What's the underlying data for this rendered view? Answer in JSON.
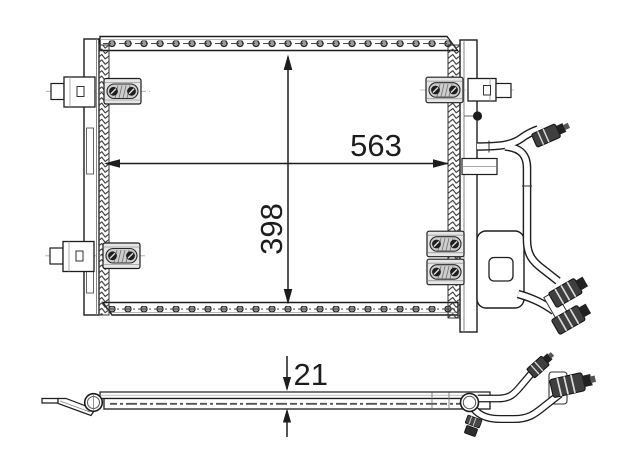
{
  "drawing": {
    "subject": "condenser-technical-drawing",
    "front_view": {
      "width_dimension_label": "563",
      "height_dimension_label": "398"
    },
    "side_view": {
      "thickness_dimension_label": "21"
    }
  },
  "colors": {
    "background": "#ffffff",
    "line": "#1d1d1b",
    "shading": "#9a9a9a",
    "bracket_fill": "#e6e6e6",
    "fitting_dark": "#3f3f3f"
  }
}
